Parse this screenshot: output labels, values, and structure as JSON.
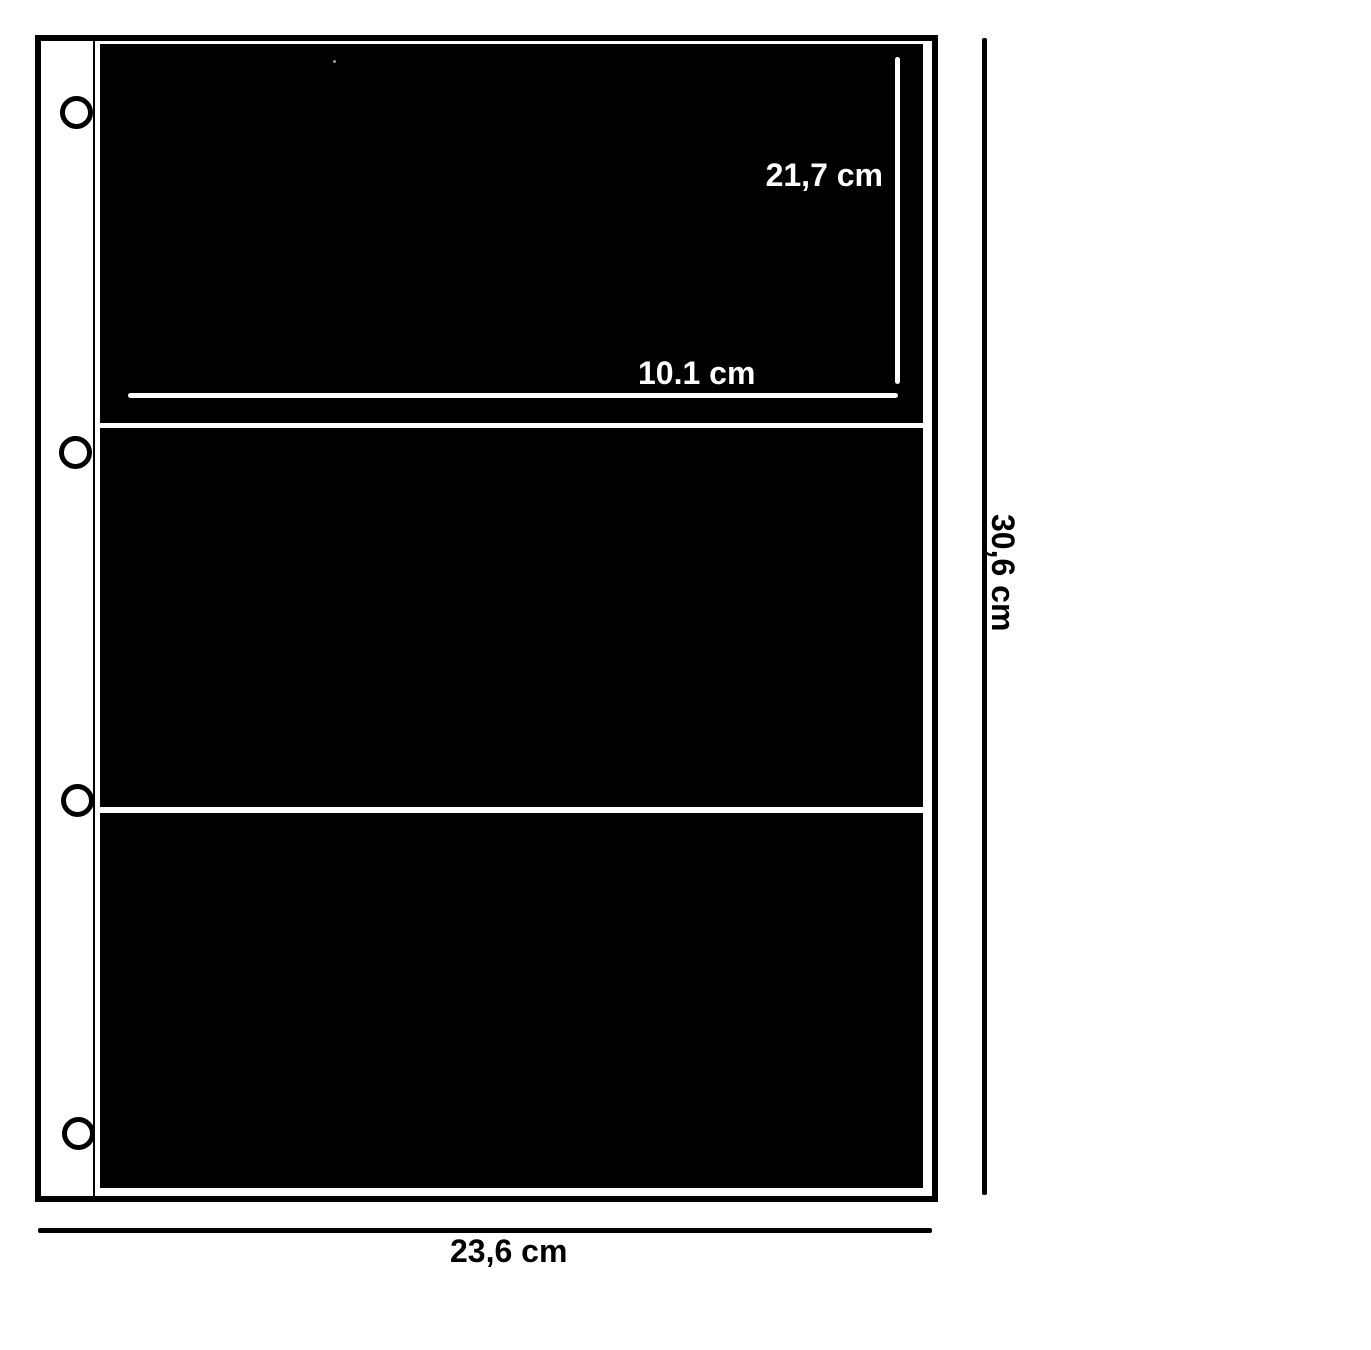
{
  "diagram": {
    "kind": "binder-pocket-page-dimension-diagram",
    "structure": {
      "pocket_count": 3,
      "punch_hole_count": 4
    },
    "colors": {
      "page_background": "#ffffff",
      "pocket_fill": "#000000",
      "outline": "#000000",
      "measure_line_on_pocket": "#ffffff",
      "label_on_pocket": "#ffffff",
      "label_on_background": "#000000"
    }
  },
  "labels": {
    "pocket_height": "21,7 cm",
    "pocket_width": "10.1 cm",
    "page_height": "30,6 cm",
    "page_width": "23,6 cm"
  }
}
